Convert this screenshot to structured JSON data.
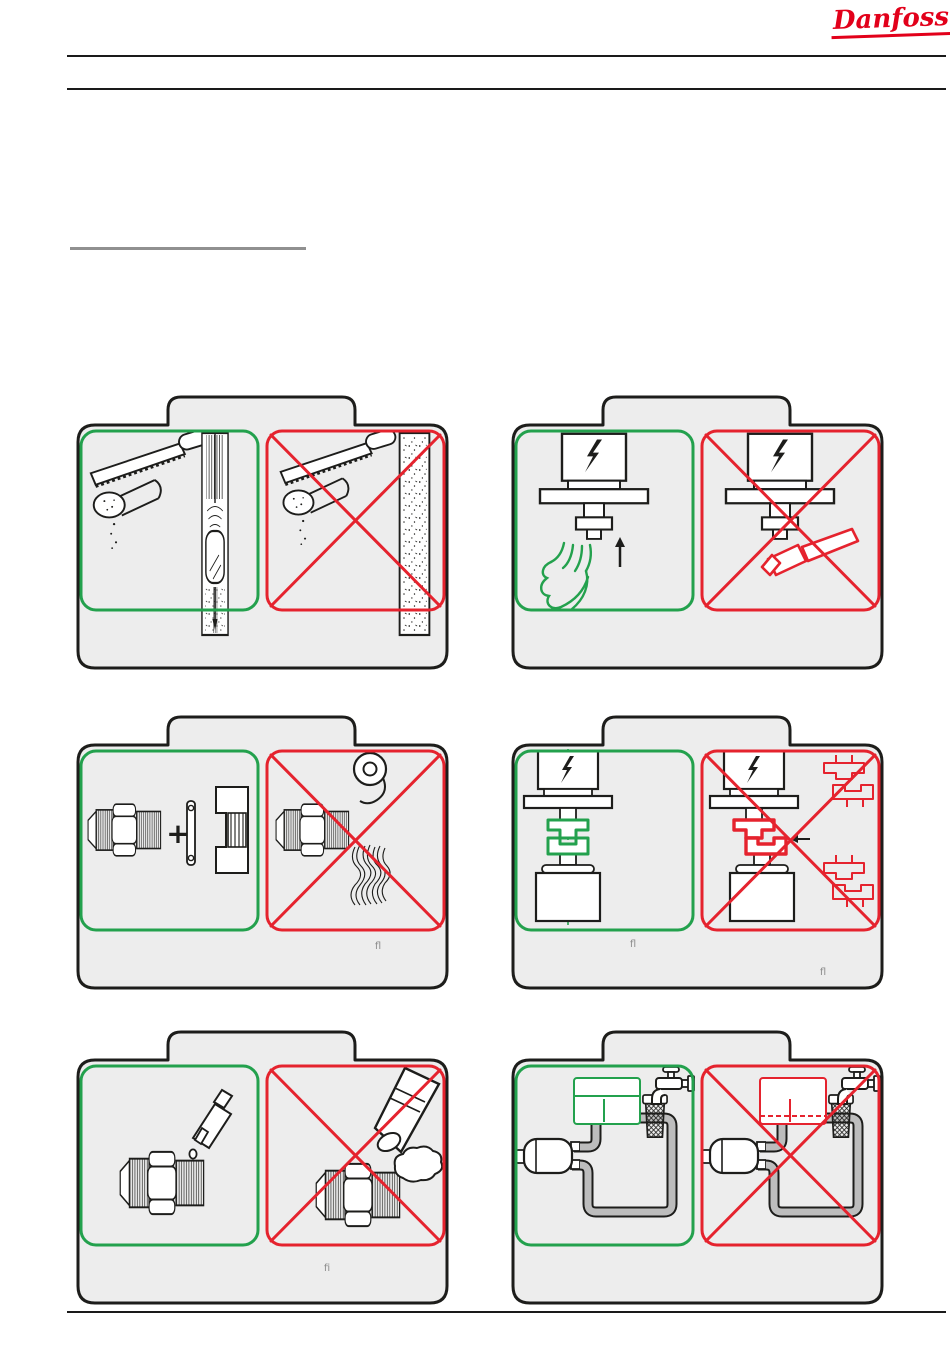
{
  "brand": {
    "logo_text": "Danfoss"
  },
  "colors": {
    "ink": "#1d1d1b",
    "green": "#23a14d",
    "red": "#e5232e",
    "panel": "#ededed",
    "pipe": "#bdbdbd",
    "pipe_edge": "#1d1d1b",
    "label": "#8c8c8c",
    "rule": "#1a1a1a",
    "gray_rule": "#909090",
    "logo": "#e2001a",
    "paper": "#ffffff"
  },
  "figure_labels": {
    "flare_dont": "fl",
    "alignment_do": "fl",
    "alignment_dont": "fl",
    "sealant_dont": "fi"
  },
  "panels": [
    {
      "id": "pipe-cutting"
    },
    {
      "id": "coil-mounting"
    },
    {
      "id": "flare-connection"
    },
    {
      "id": "coil-alignment"
    },
    {
      "id": "thread-sealant"
    },
    {
      "id": "water-connection"
    }
  ]
}
